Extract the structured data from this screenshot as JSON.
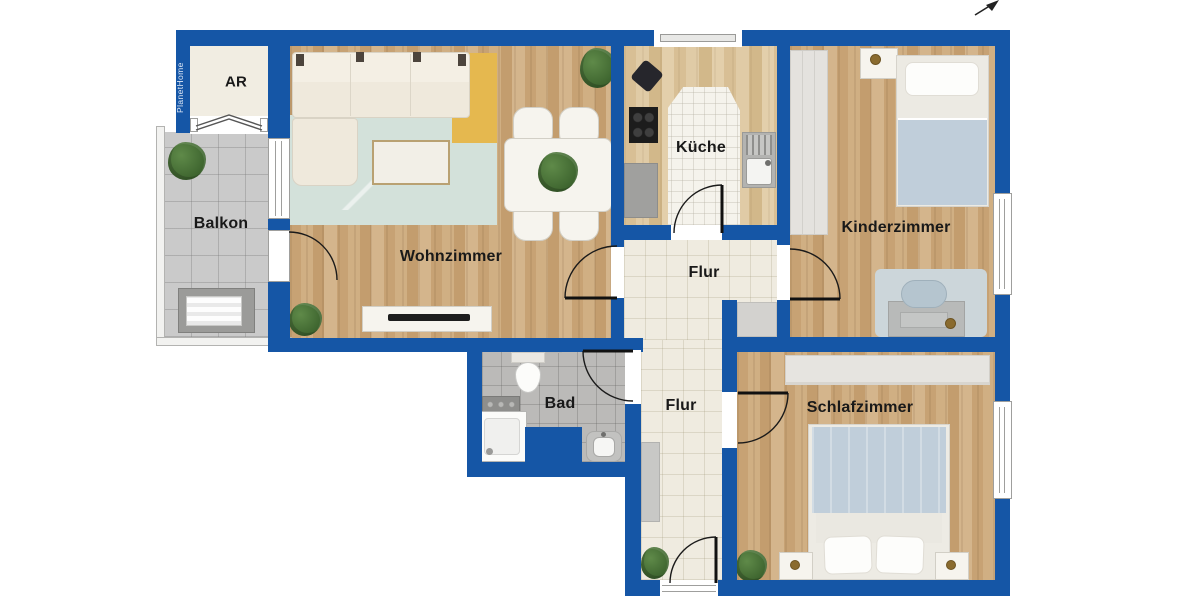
{
  "watermark": {
    "brand": "PlanetHome"
  },
  "compass": {
    "name": "north-arrow"
  },
  "rooms": [
    {
      "id": "ar",
      "label": "AR"
    },
    {
      "id": "balkon",
      "label": "Balkon"
    },
    {
      "id": "wohnzimmer",
      "label": "Wohnzimmer"
    },
    {
      "id": "kueche",
      "label": "Küche"
    },
    {
      "id": "kinderzimmer",
      "label": "Kinderzimmer"
    },
    {
      "id": "bad",
      "label": "Bad"
    },
    {
      "id": "flur_oben",
      "label": "Flur"
    },
    {
      "id": "flur_unten",
      "label": "Flur"
    },
    {
      "id": "schlafzimmer",
      "label": "Schlafzimmer"
    }
  ],
  "colors": {
    "wall": "#1556a6",
    "tile_hall": "#efebe0",
    "tile_bath": "#bbbab8",
    "balcony_floor": "#cacaca",
    "rug_teal": "#d3e1da",
    "rug_yellow": "#e5b84f",
    "bedding_blue": "#c0ceda",
    "furniture_cream": "#efe9dc"
  }
}
